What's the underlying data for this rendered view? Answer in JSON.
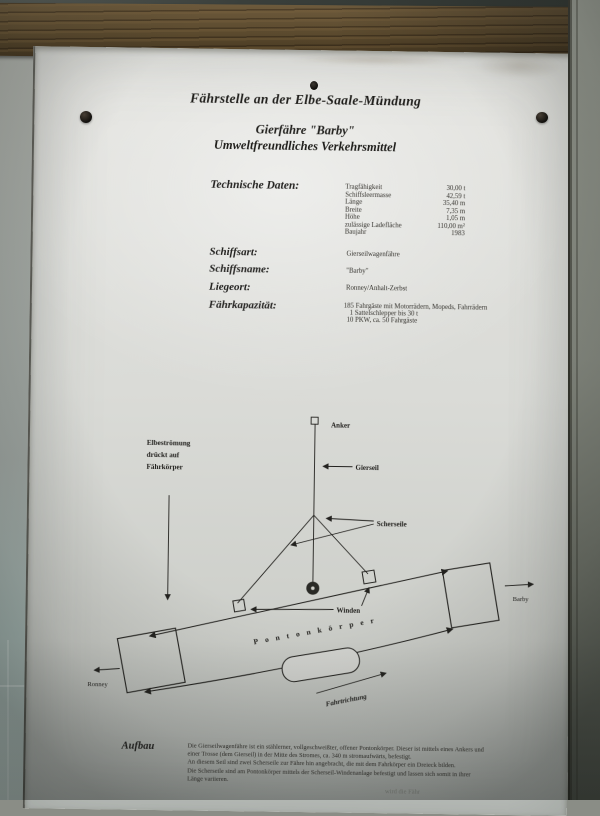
{
  "colors": {
    "paper": "#d9dad6",
    "ink": "#2b2a26",
    "wood": "#5b4a2e"
  },
  "header": {
    "line1": "Fährstelle an der Elbe-Saale-Mündung",
    "line2": "Gierfähre \"Barby\"",
    "line3": "Umweltfreundliches Verkehrsmittel"
  },
  "technical": {
    "heading": "Technische Daten:",
    "rows": [
      {
        "label": "Tragfähigkeit",
        "value": "30,00 t"
      },
      {
        "label": "Schiffsleermasse",
        "value": "42,59 t"
      },
      {
        "label": "Länge",
        "value": "35,40 m"
      },
      {
        "label": "Breite",
        "value": "7,35 m"
      },
      {
        "label": "Höhe",
        "value": "1,05 m"
      },
      {
        "label": "zulässige Ladefläche",
        "value": "110,00 m²"
      },
      {
        "label": "Baujahr",
        "value": "1983"
      }
    ]
  },
  "details": {
    "schiffsart_label": "Schiffsart:",
    "schiffsart_value": "Gierseilwagenfähre",
    "schiffsname_label": "Schiffsname:",
    "schiffsname_value": "\"Barby\"",
    "liegeort_label": "Liegeort:",
    "liegeort_value": "Ronney/Anhalt-Zerbst",
    "kapazitaet_label": "Fährkapazität:",
    "kapazitaet_line1": "185 Fahrgäste mit Motorrädern, Mopeds, Fahrrädern",
    "kapazitaet_line2": "1 Sattelschlepper bis 30 t",
    "kapazitaet_line3": "10 PKW, ca. 50 Fahrgäste"
  },
  "diagram": {
    "stream_line1": "Elbeströmung",
    "stream_line2": "drückt auf",
    "stream_line3": "Fährkörper",
    "anker": "Anker",
    "gierseil": "Gierseil",
    "scherseile": "Scherseile",
    "winden": "Winden",
    "pontonkoerper": "Pontonkörper",
    "fahrtrichtung": "Fahrtrichtung",
    "ronney": "Ronney",
    "barby": "Barby"
  },
  "aufbau": {
    "heading": "Aufbau",
    "lines": [
      "Die Gierseilwagenfähre ist ein stählerner, vollgeschweißter, offener Pontonkörper. Dieser ist mittels eines Ankers und",
      "einer Trosse (dem Gierseil) in der Mitte des Stromes, ca. 340 m stromaufwärts, befestigt.",
      "An diesem Seil sind zwei Scherseile zur Fähre hin angebracht, die mit dem Fahrkörper ein Dreieck bilden.",
      "Die Scherseile sind am Pontonkörper mittels der Scherseil-Windenanlage befestigt und lassen sich somit in ihrer",
      "Länge variieren."
    ]
  },
  "footer_fragment": "wird die Fähr"
}
